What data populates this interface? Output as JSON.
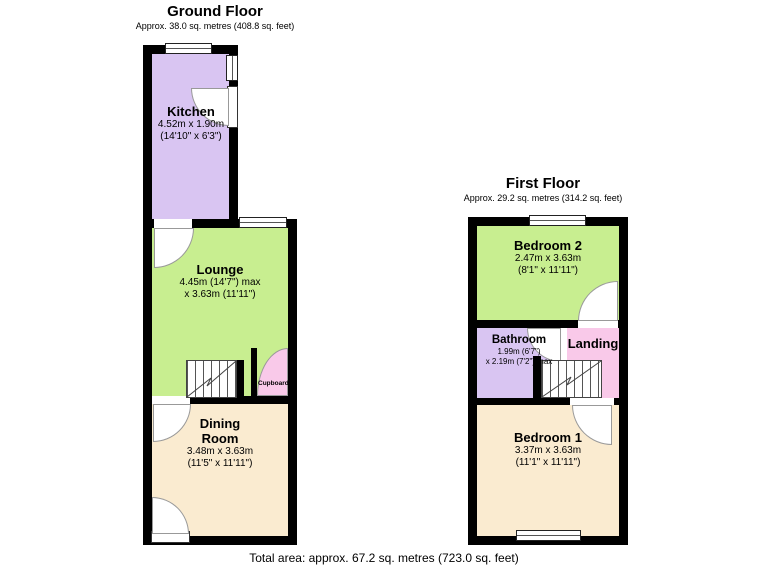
{
  "ground_floor": {
    "title": "Ground Floor",
    "subtitle": "Approx. 38.0 sq. metres (408.8 sq. feet)",
    "kitchen": {
      "name": "Kitchen",
      "dim1": "4.52m x 1.90m",
      "dim2": "(14'10\" x 6'3\")"
    },
    "lounge": {
      "name": "Lounge",
      "dim1": "4.45m (14'7\") max",
      "dim2": "x 3.63m (11'11\")"
    },
    "dining": {
      "name": "Dining Room",
      "dim1": "3.48m x 3.63m",
      "dim2": "(11'5\" x 11'11\")"
    },
    "cupboard": {
      "name": "Cupboard"
    }
  },
  "first_floor": {
    "title": "First Floor",
    "subtitle": "Approx. 29.2 sq. metres (314.2 sq. feet)",
    "bedroom2": {
      "name": "Bedroom 2",
      "dim1": "2.47m x 3.63m",
      "dim2": "(8'1\" x 11'11\")"
    },
    "bathroom": {
      "name": "Bathroom",
      "dim1": "1.99m (6'7\")",
      "dim2": "x 2.19m (7'2\") max"
    },
    "landing": {
      "name": "Landing"
    },
    "bedroom1": {
      "name": "Bedroom 1",
      "dim1": "3.37m x 3.63m",
      "dim2": "(11'1\" x 11'11\")"
    }
  },
  "footer": "Total area: approx. 67.2 sq. metres (723.0 sq. feet)",
  "colors": {
    "wall": "#000000",
    "kitchen": "#d9c5f2",
    "lounge": "#c8ee90",
    "dining_room": "#faebd0",
    "cupboard": "#f9c9e9",
    "bedroom2": "#c8ee90",
    "bathroom": "#d9c5f2",
    "landing": "#f9c9e9",
    "bedroom1": "#faebd0",
    "door_arc": "#999999"
  }
}
